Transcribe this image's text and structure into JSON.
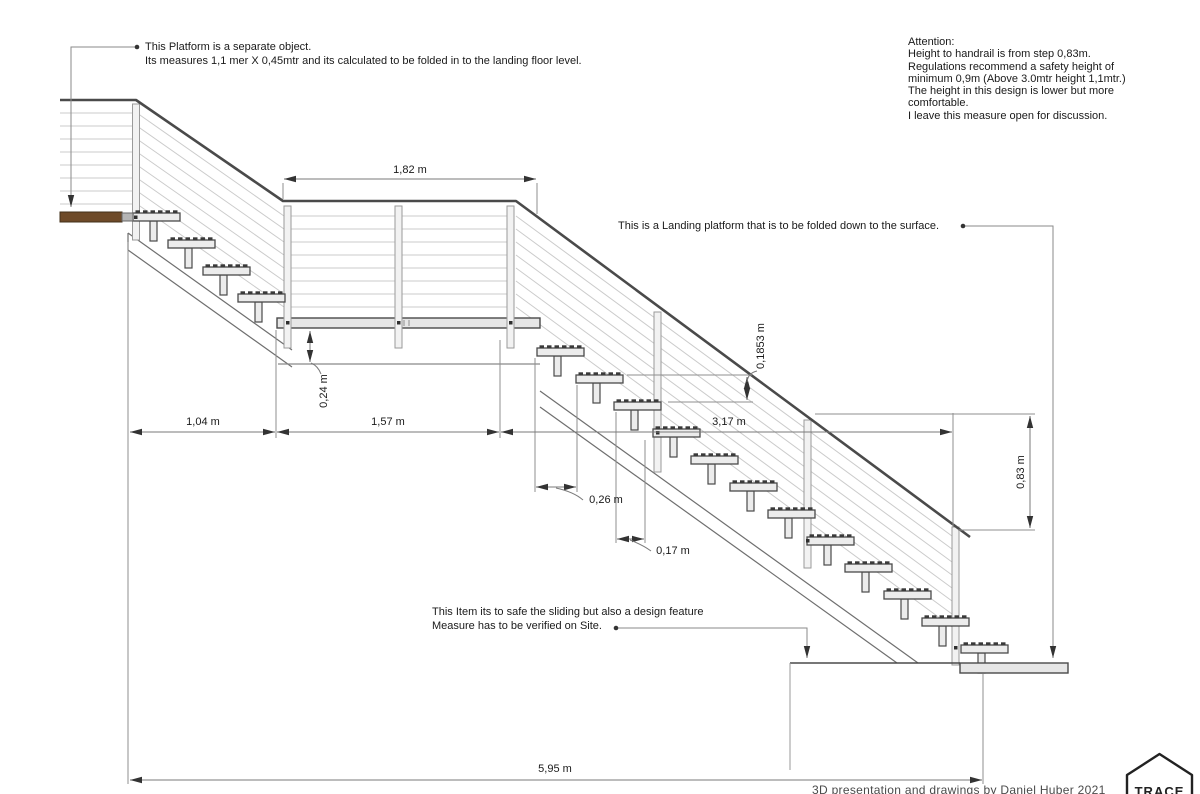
{
  "canvas": {
    "width": 1200,
    "height": 794,
    "background": "#ffffff"
  },
  "colors": {
    "structure_line": "#4a4a4a",
    "cable_line": "#cbcbcb",
    "dimension_line": "#7a7a7a",
    "arrowhead": "#333333",
    "step_fill": "#ececec",
    "post_fill": "#f2f2f2",
    "platform_fill": "#e6e6e6",
    "wood_platform_fill": "#6e4a28",
    "text": "#1a1a1a"
  },
  "notes": {
    "platform_note_line1": "This Platform is a separate object.",
    "platform_note_line2": "Its measures 1,1 mer X 0,45mtr and its calculated to be folded in to the landing floor level.",
    "attention_lines": [
      "Attention:",
      "Height to handrail is from step 0,83m.",
      "Regulations recommend a safety height of",
      "minimum 0,9m (Above 3.0mtr height 1,1mtr.)",
      "The height in this design is lower but more",
      "comfortable.",
      "I leave this measure open for discussion."
    ],
    "landing_note": "This is a Landing platform that is to be folded down to the surface.",
    "slide_note_line1": "This Item its to safe the sliding but also a design feature",
    "slide_note_line2": "Measure has to be verified on Site.",
    "credit": "3D presentation and drawings by Daniel Huber 2021",
    "logo_text": "TRACE"
  },
  "dimensions": {
    "rail_span": "1,82 m",
    "landing_drop": "0,24 m",
    "run_top_platform": "1,04 m",
    "run_landing": "1,57 m",
    "run_lower_flight": "3,17 m",
    "step_rise": "0,1853 m",
    "step_depth": "0,26 m",
    "step_overlap": "0,17 m",
    "handrail_height": "0,83 m",
    "total_run": "5,95 m"
  }
}
